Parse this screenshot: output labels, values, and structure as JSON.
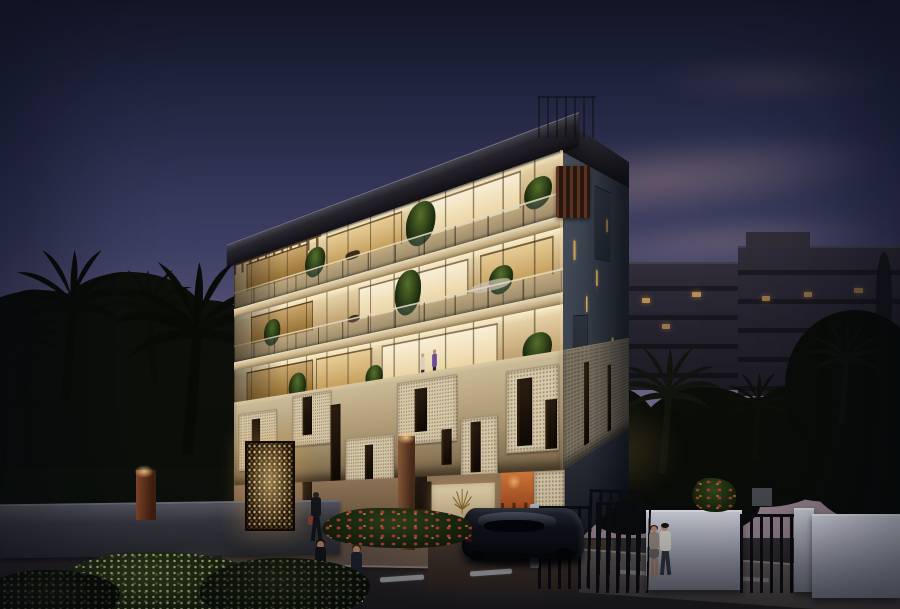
{
  "meta": {
    "type": "architectural-rendering",
    "time_of_day": "dusk",
    "caption": "Modern five-storey apartment residence at dusk with illuminated terraces, mosaic balcony band, palm trees, pedestrians and a parked sports car"
  },
  "building": {
    "sign_text": "VILLA SORAYA",
    "sign_logo": "fan-palm-leaf",
    "storeys_visible": 5,
    "lit_terrace_floors": 3
  },
  "scene_counts": {
    "pedestrians_crossing": 2,
    "pedestrian_at_entrance": 1,
    "couple_by_wall": 2,
    "people_on_terrace": 2,
    "cars": 1
  },
  "palette": {
    "sky_top": "#1e2238",
    "sky_mid": "#3c3f63",
    "sky_low": "#8a7791",
    "cloud_pink": "#d8a79a",
    "horizon_glow": "#d9955e",
    "roof_dark": "#131116",
    "facade_wall": "#cdb181",
    "interior_bright": "#f9eed6",
    "slab_light": "#eadcbb",
    "side_wall": "#343b47",
    "mosaic_cream": "#d6c8aa",
    "slot_dark": "#1c130b",
    "ground_wall": "#7c6347",
    "terracotta": "#a84d20",
    "sign_bg": "#cbb488",
    "sign_gold": "#8a6b2e",
    "foliage_dark": "#0c0f0a",
    "flower_red": "#c2413a",
    "street_asphalt": "#2b2728",
    "road_marking": "#c9ccd1",
    "sidewalk_warm": "#7a6450",
    "wall_white": "#b9bbc7",
    "metal_dark": "#0c0d11",
    "car_body": "#07080c",
    "bg_building": "#262430",
    "bg_window": "#c89a54",
    "tile_roof": "#414a57"
  }
}
